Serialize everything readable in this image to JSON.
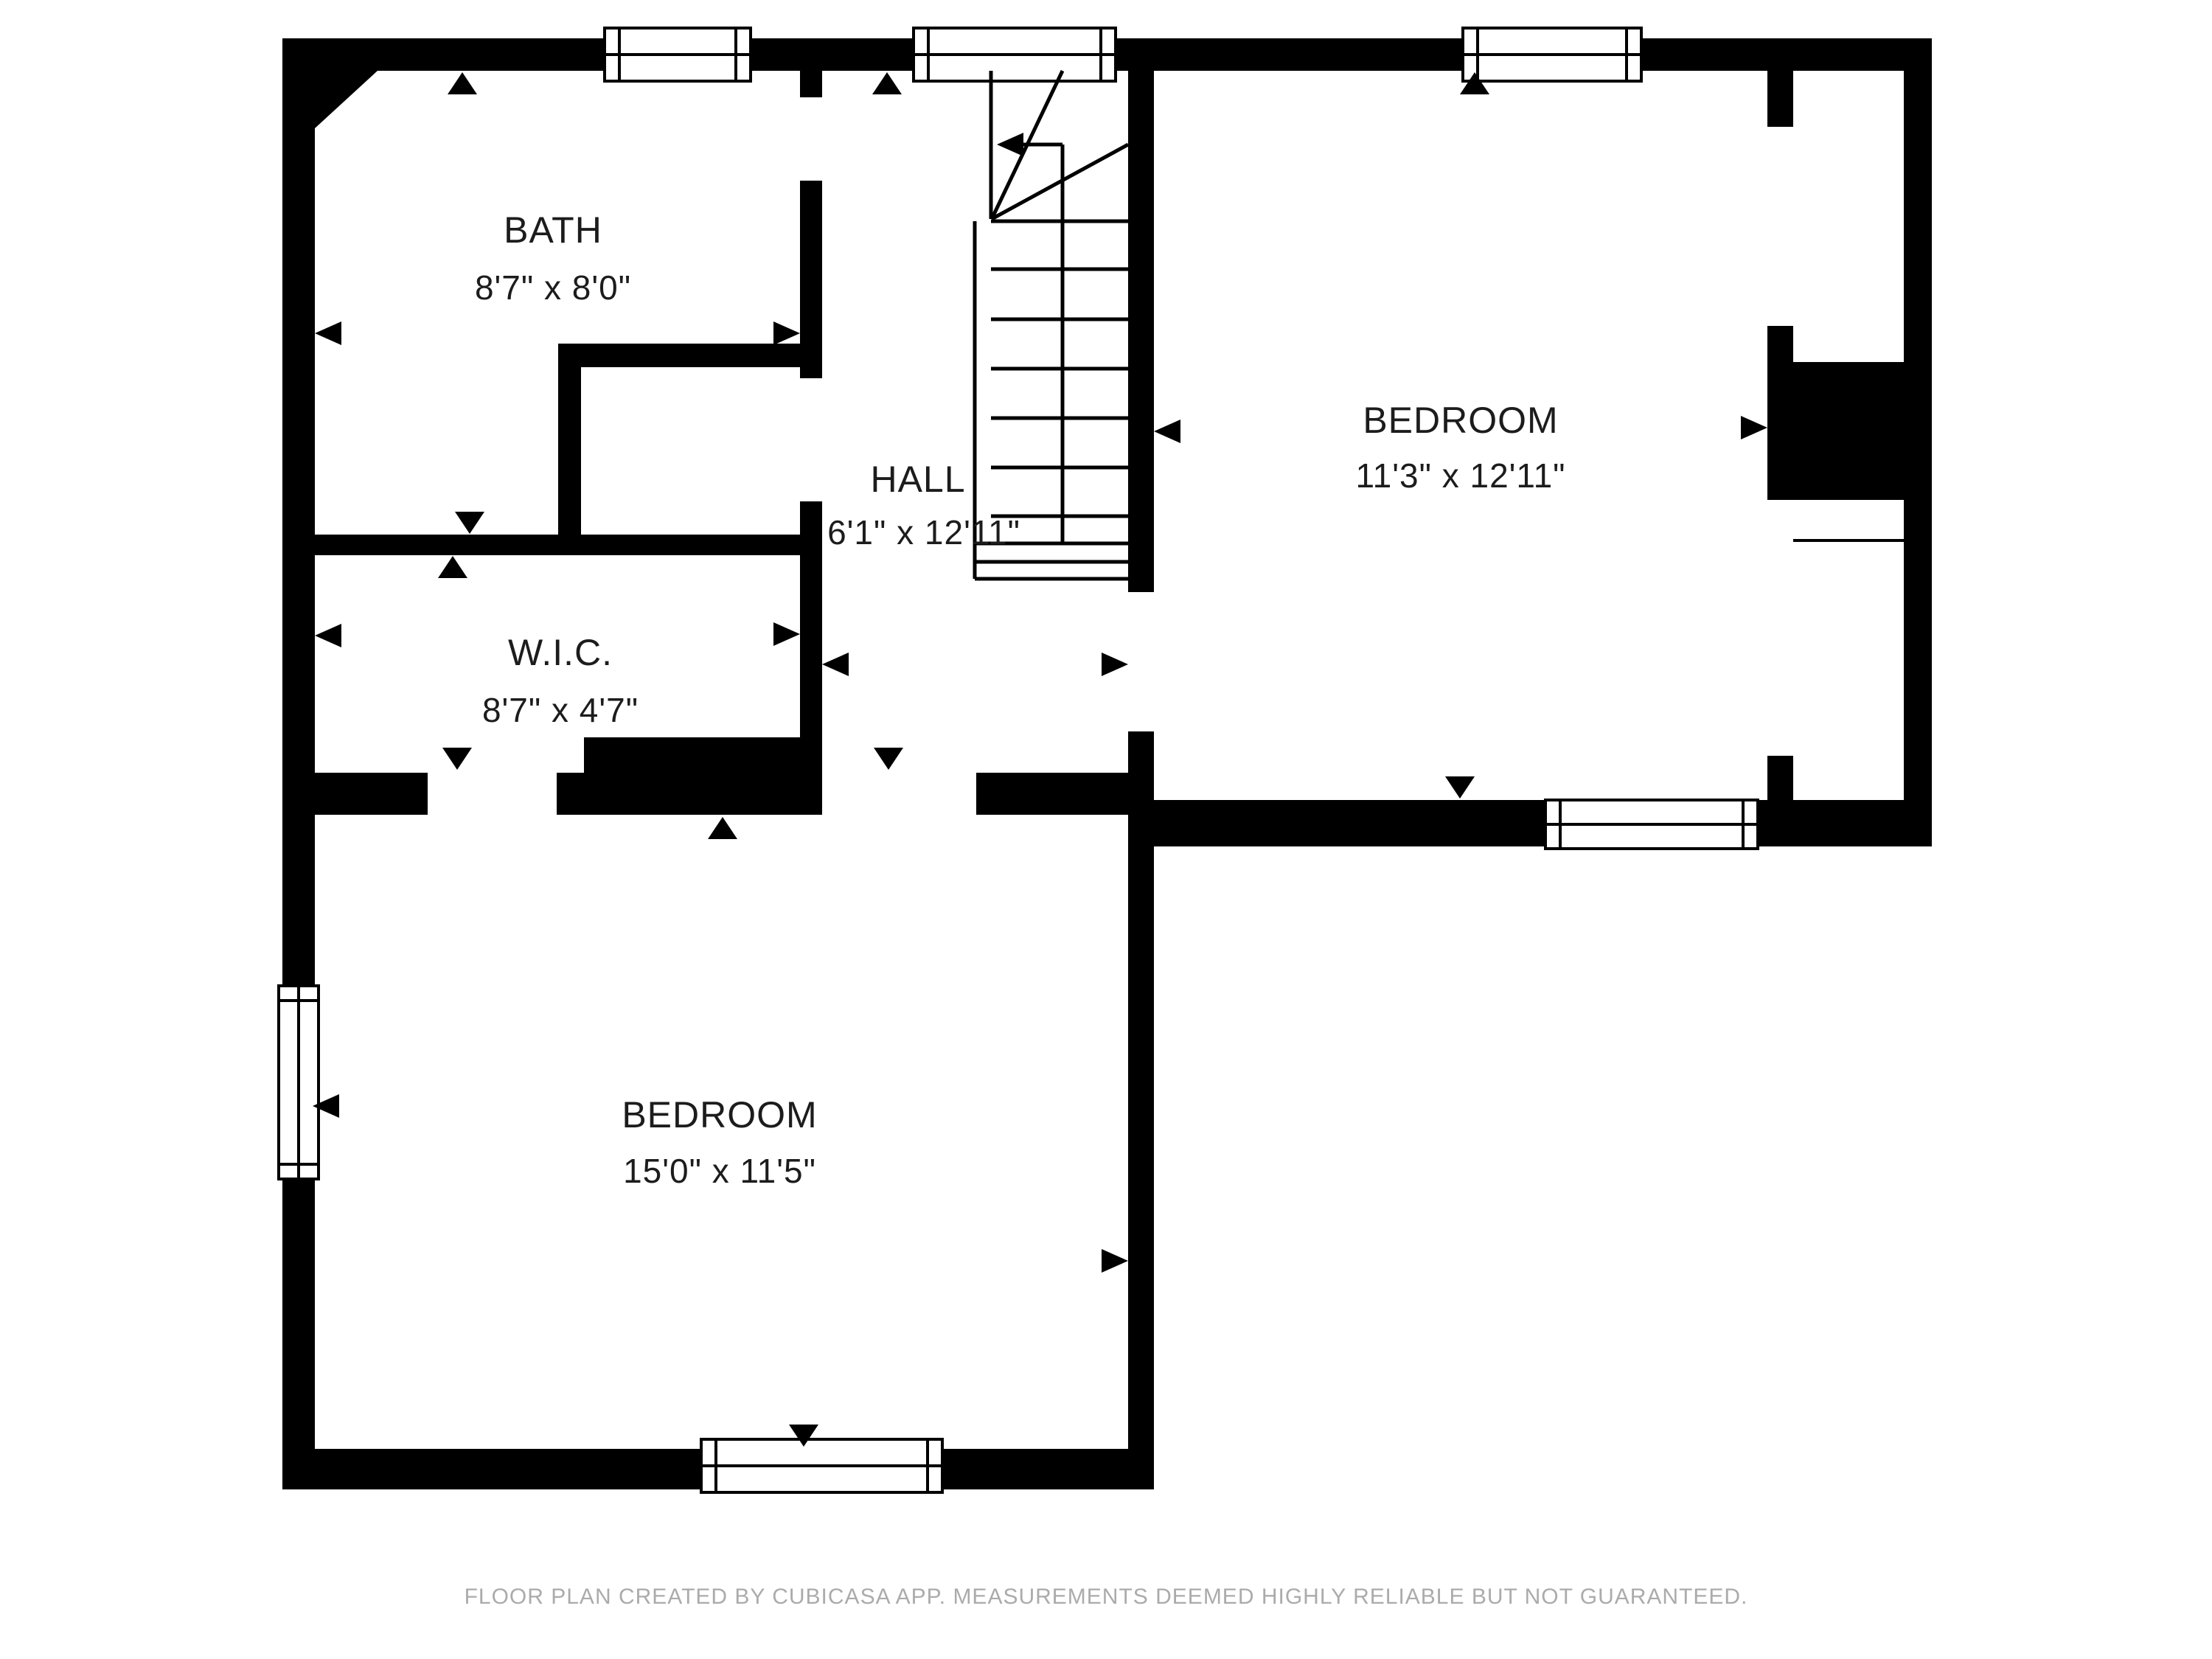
{
  "title": "Second floor plan",
  "rooms": [
    {
      "id": "bath",
      "label": "BATH",
      "dimensions": "8'7\" x 8'0\""
    },
    {
      "id": "hall",
      "label": "HALL",
      "dimensions": "6'1\" x 12'11\""
    },
    {
      "id": "bedroom-upper",
      "label": "BEDROOM",
      "dimensions": "11'3\" x 12'11\""
    },
    {
      "id": "wic",
      "label": "W.I.C.",
      "dimensions": "8'7\" x 4'7\""
    },
    {
      "id": "bedroom-lower",
      "label": "BEDROOM",
      "dimensions": "15'0\" x 11'5\""
    }
  ],
  "footer": {
    "text": "FLOOR PLAN CREATED BY CUBICASA APP. MEASUREMENTS DEEMED HIGHLY RELIABLE BUT NOT GUARANTEED."
  },
  "colors": {
    "wall": "#000000",
    "background": "#ffffff",
    "label": "#1c1c1c",
    "footer_text": "#ABABAB"
  },
  "features": {
    "windows": 6,
    "staircase": "U-shaped stair with winders in hall, up-direction arrow pointing left",
    "door_openings": [
      "hall-to-bath",
      "hall-to-closet-nook",
      "hall-to-upper-bedroom",
      "hall-to-lower-bedroom",
      "lower-bedroom-to-wic",
      "upper-bedroom-to-closet-top",
      "upper-bedroom-to-closet-bottom"
    ]
  }
}
